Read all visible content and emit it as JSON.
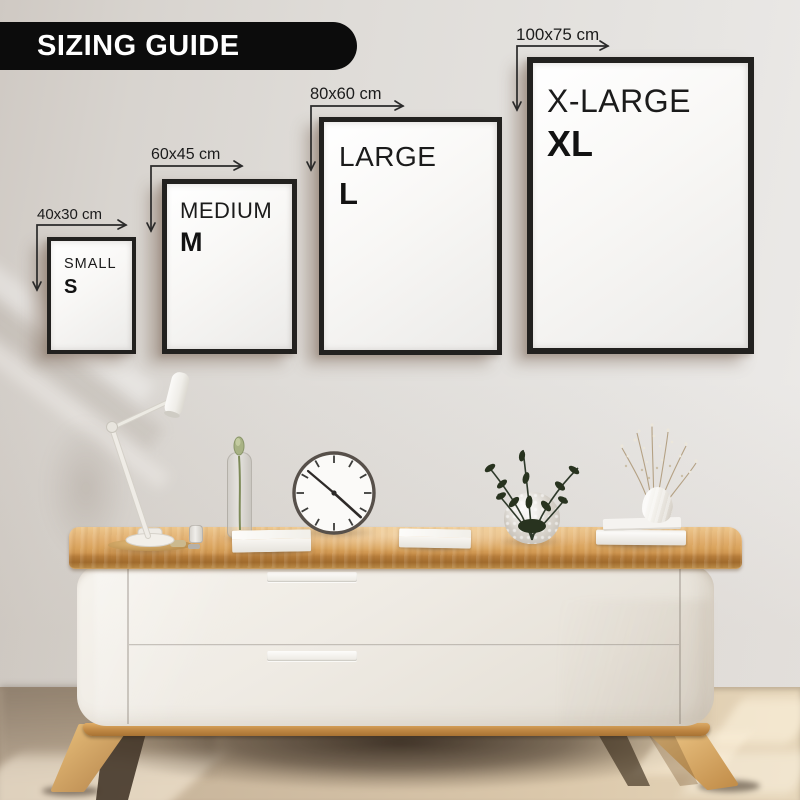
{
  "banner": {
    "title": "SIZING GUIDE"
  },
  "sizes": [
    {
      "dimensions": "40x30 cm",
      "name": "SMALL",
      "abbr": "S"
    },
    {
      "dimensions": "60x45 cm",
      "name": "MEDIUM",
      "abbr": "M"
    },
    {
      "dimensions": "80x60 cm",
      "name": "LARGE",
      "abbr": "L"
    },
    {
      "dimensions": "100x75 cm",
      "name": "X-LARGE",
      "abbr": "XL"
    }
  ],
  "colors": {
    "banner_bg": "#0c0c0c",
    "banner_text": "#ffffff",
    "frame_border": "#22211f",
    "label_text": "#1c1c1c",
    "wall": "#e0ddd9",
    "wood": "#d8a55f",
    "cabinet_body": "#efebe4",
    "floor": "#d2bfa4"
  }
}
